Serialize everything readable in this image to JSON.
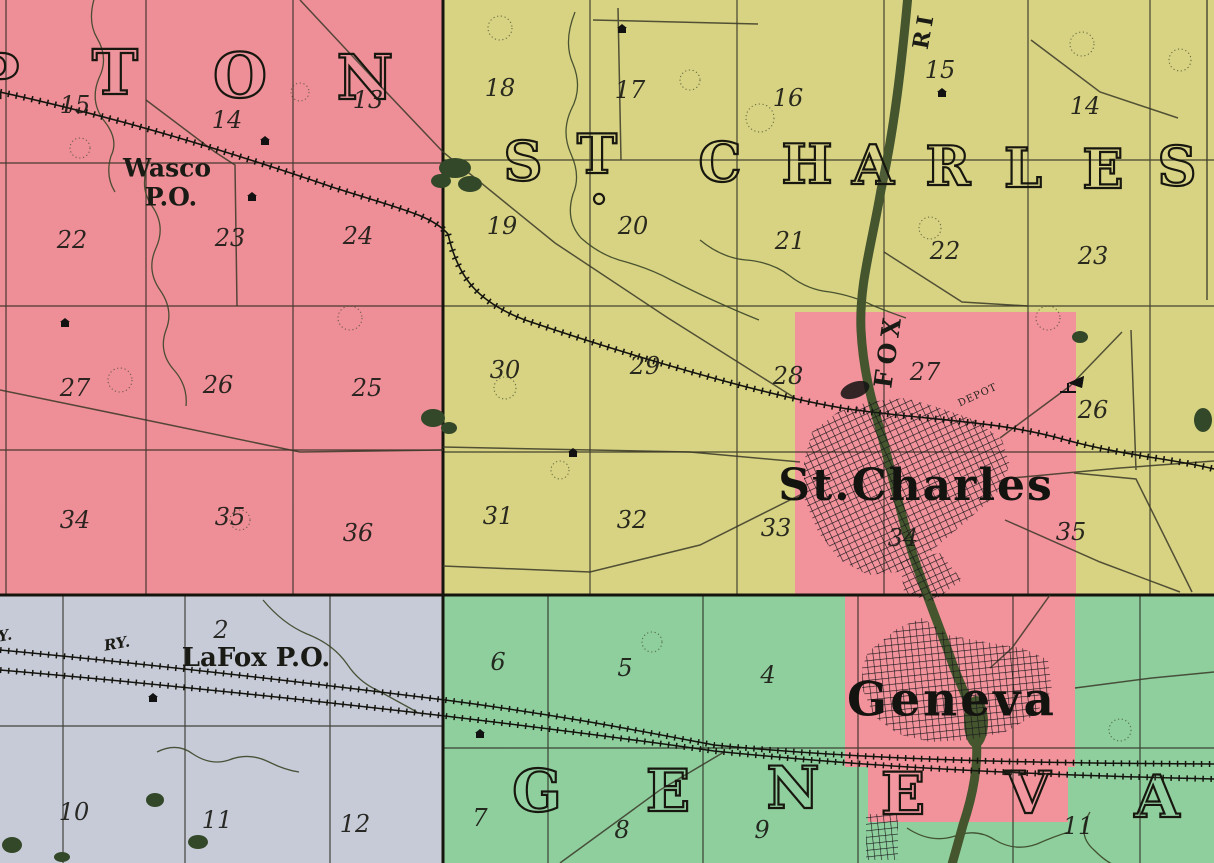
{
  "map": {
    "type": "vintage-county-atlas-plat-map",
    "colors": {
      "campton_pink": "#ee8f97",
      "st_charles_yellow": "#d8d383",
      "geneva_green": "#8fcf9e",
      "west_gray": "#c7cbd8",
      "city_pink": "#f2929b",
      "river_green": "#45552e",
      "foliage_green": "#334828",
      "ink": "#1c1c16"
    },
    "townships": [
      {
        "id": "campton",
        "visible_name": "PTON",
        "font_px": 62,
        "letters": [
          {
            "t": "P",
            "x": -4,
            "y": 77
          },
          {
            "t": "T",
            "x": 115,
            "y": 73
          },
          {
            "t": "O",
            "x": 240,
            "y": 76
          },
          {
            "t": "N",
            "x": 365,
            "y": 78
          }
        ]
      },
      {
        "id": "st-charles",
        "visible_name": "ST. CHARLES",
        "font_px": 54,
        "letters": [
          {
            "t": "S",
            "x": 523,
            "y": 161
          },
          {
            "t": "T",
            "x": 597,
            "y": 154
          },
          {
            "t": ".",
            "x": 599,
            "y": 184
          },
          {
            "t": "C",
            "x": 720,
            "y": 162
          },
          {
            "t": "H",
            "x": 807,
            "y": 164
          },
          {
            "t": "A",
            "x": 873,
            "y": 165
          },
          {
            "t": "R",
            "x": 948,
            "y": 166
          },
          {
            "t": "L",
            "x": 1023,
            "y": 168
          },
          {
            "t": "E",
            "x": 1103,
            "y": 169
          },
          {
            "t": "S",
            "x": 1177,
            "y": 166
          }
        ]
      },
      {
        "id": "geneva",
        "visible_name": "GENEVA",
        "font_px": 58,
        "letters": [
          {
            "t": "G",
            "x": 537,
            "y": 791
          },
          {
            "t": "E",
            "x": 668,
            "y": 791
          },
          {
            "t": "N",
            "x": 793,
            "y": 788
          },
          {
            "t": "E",
            "x": 903,
            "y": 794
          },
          {
            "t": "V",
            "x": 1028,
            "y": 793
          },
          {
            "t": "A",
            "x": 1157,
            "y": 797
          }
        ]
      }
    ],
    "labels": [
      {
        "name": "city-label-st-charles",
        "text": "St.Charles",
        "cls": "city",
        "x": 916,
        "y": 486
      },
      {
        "name": "city-label-geneva",
        "text": "Geneva",
        "cls": "city2",
        "x": 952,
        "y": 700
      },
      {
        "name": "wasco-po-label-line1",
        "text": "Wasco",
        "cls": "po",
        "x": 167,
        "y": 168
      },
      {
        "name": "wasco-po-label-line2",
        "text": "P.O.",
        "cls": "po",
        "x": 171,
        "y": 197
      },
      {
        "name": "lafox-po-label",
        "text": "LaFox P.O.",
        "cls": "po2",
        "x": 256,
        "y": 658
      },
      {
        "name": "railway-label",
        "text": "RY.",
        "cls": "rwy",
        "x": 117,
        "y": 644,
        "rot": -10
      },
      {
        "name": "railway-label-partial",
        "text": "Y.",
        "cls": "rwy",
        "x": 5,
        "y": 636,
        "rot": -10
      },
      {
        "name": "fox-river-label",
        "text": "FOX",
        "cls": "river-label",
        "x": 888,
        "y": 350,
        "rot": -82
      },
      {
        "name": "river-label-partial",
        "text": "RI",
        "cls": "river-label2",
        "x": 924,
        "y": 30,
        "rot": -80
      },
      {
        "name": "depot-label",
        "text": "DEPOT",
        "cls": "depot",
        "x": 978,
        "y": 396,
        "rot": -25
      }
    ],
    "sections": [
      {
        "n": 15,
        "x": 75,
        "y": 105
      },
      {
        "n": 14,
        "x": 227,
        "y": 120
      },
      {
        "n": 13,
        "x": 368,
        "y": 100
      },
      {
        "n": 22,
        "x": 72,
        "y": 240
      },
      {
        "n": 23,
        "x": 230,
        "y": 238
      },
      {
        "n": 24,
        "x": 358,
        "y": 236
      },
      {
        "n": 27,
        "x": 75,
        "y": 388
      },
      {
        "n": 26,
        "x": 218,
        "y": 385
      },
      {
        "n": 25,
        "x": 367,
        "y": 388
      },
      {
        "n": 34,
        "x": 75,
        "y": 520
      },
      {
        "n": 35,
        "x": 230,
        "y": 517
      },
      {
        "n": 36,
        "x": 358,
        "y": 533
      },
      {
        "n": 18,
        "x": 500,
        "y": 88
      },
      {
        "n": 17,
        "x": 630,
        "y": 90
      },
      {
        "n": 16,
        "x": 788,
        "y": 98
      },
      {
        "n": 15,
        "x": 940,
        "y": 70
      },
      {
        "n": 14,
        "x": 1085,
        "y": 106
      },
      {
        "n": 19,
        "x": 502,
        "y": 226
      },
      {
        "n": 20,
        "x": 633,
        "y": 226
      },
      {
        "n": 21,
        "x": 790,
        "y": 241
      },
      {
        "n": 22,
        "x": 945,
        "y": 251
      },
      {
        "n": 23,
        "x": 1093,
        "y": 256
      },
      {
        "n": 30,
        "x": 505,
        "y": 370
      },
      {
        "n": 29,
        "x": 645,
        "y": 366
      },
      {
        "n": 28,
        "x": 788,
        "y": 376
      },
      {
        "n": 27,
        "x": 925,
        "y": 372
      },
      {
        "n": 26,
        "x": 1093,
        "y": 410
      },
      {
        "n": 31,
        "x": 498,
        "y": 516
      },
      {
        "n": 32,
        "x": 632,
        "y": 520
      },
      {
        "n": 33,
        "x": 776,
        "y": 528
      },
      {
        "n": 34,
        "x": 903,
        "y": 538
      },
      {
        "n": 35,
        "x": 1071,
        "y": 532
      },
      {
        "n": 2,
        "x": 221,
        "y": 630
      },
      {
        "n": 10,
        "x": 74,
        "y": 812
      },
      {
        "n": 11,
        "x": 217,
        "y": 820
      },
      {
        "n": 12,
        "x": 355,
        "y": 824
      },
      {
        "n": 6,
        "x": 498,
        "y": 662
      },
      {
        "n": 5,
        "x": 625,
        "y": 668
      },
      {
        "n": 4,
        "x": 768,
        "y": 675
      },
      {
        "n": 7,
        "x": 480,
        "y": 818
      },
      {
        "n": 8,
        "x": 622,
        "y": 830
      },
      {
        "n": 9,
        "x": 762,
        "y": 830
      },
      {
        "n": 11,
        "x": 1078,
        "y": 826
      }
    ]
  }
}
